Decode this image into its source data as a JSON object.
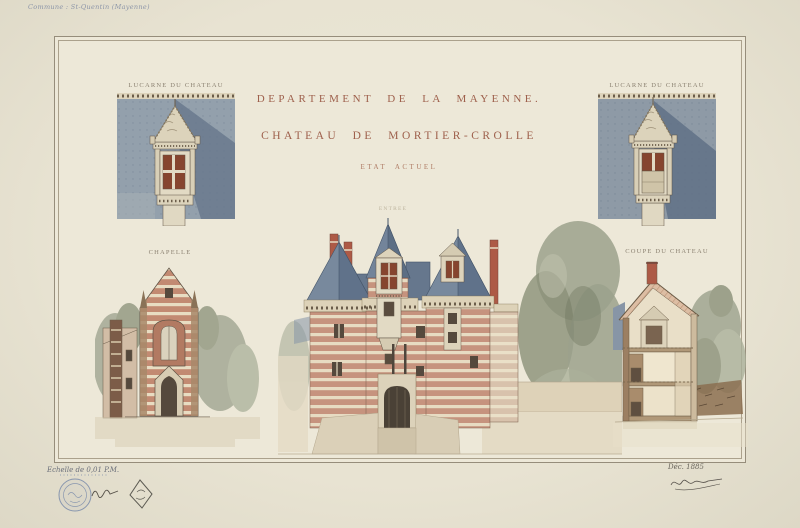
{
  "sheet": {
    "corner_note": "Commune : St-Quentin (Mayenne)",
    "scale_note": "Echelle de 0,01 P.M.",
    "date_note": "Déc. 1885",
    "stamps": [
      "circular-ink-stamp",
      "lozenge-stamp",
      "inventory-scribble"
    ],
    "signature": "architect-signature-flourish"
  },
  "title": {
    "line1": "DEPARTEMENT DE LA MAYENNE.",
    "line2": "CHATEAU DE MORTIER-CROLLE",
    "line3": "ETAT ACTUEL"
  },
  "figures": {
    "lucarne_left": {
      "caption": "LUCARNE DU CHATEAU"
    },
    "lucarne_right": {
      "caption": "LUCARNE DU CHATEAU"
    },
    "chapelle": {
      "caption": "CHAPELLE"
    },
    "chateau": {
      "caption": "ENTREE"
    },
    "coupe": {
      "caption": "COUPE DU CHATEAU"
    }
  },
  "colors": {
    "paper": "#ece7d7",
    "title_ink": "#9e604c",
    "caption_ink": "#8b8171",
    "slate_roof": "#78899d",
    "brick": "#c6937e",
    "brick_chimney": "#ad5a46",
    "stone": "#ddd3bb",
    "foliage": "#9ba18c",
    "stamp_blue": "#7386a8",
    "handwriting_blue": "#7d89a2"
  }
}
